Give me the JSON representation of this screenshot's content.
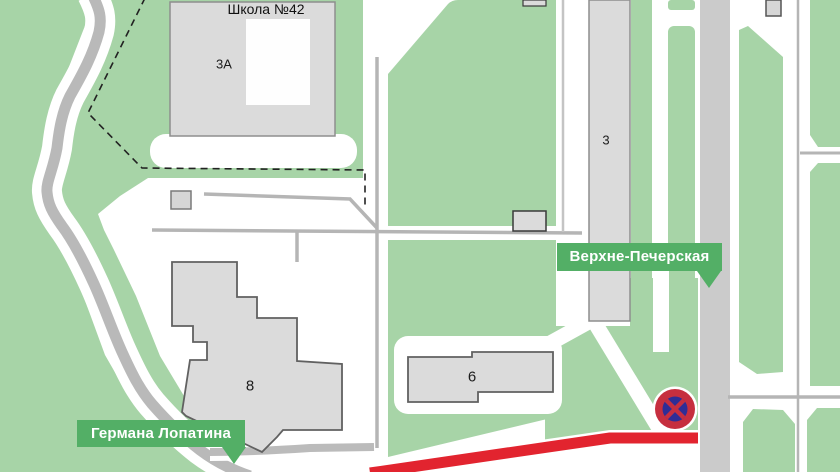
{
  "map": {
    "school": {
      "title": "Школа №42",
      "number": "3А"
    },
    "buildings": {
      "b3": "3",
      "b8": "8",
      "b6": "6"
    },
    "street_labels": {
      "verkhne_pecherskaya": "Верхне-Печерская",
      "germana_lopatina": "Германа Лопатина"
    },
    "road_sign": {
      "type": "no-stopping"
    },
    "route_highlight": {
      "color": "#E2242F"
    },
    "colors": {
      "map_green": "#A7D4A7",
      "label_green": "#53AF66",
      "route_red": "#E2242F",
      "sign_red": "#C62F3F",
      "sign_blue": "#2E2D96",
      "building_fill": "#DBDBDB",
      "road_gray": "#CBCBCB"
    }
  }
}
